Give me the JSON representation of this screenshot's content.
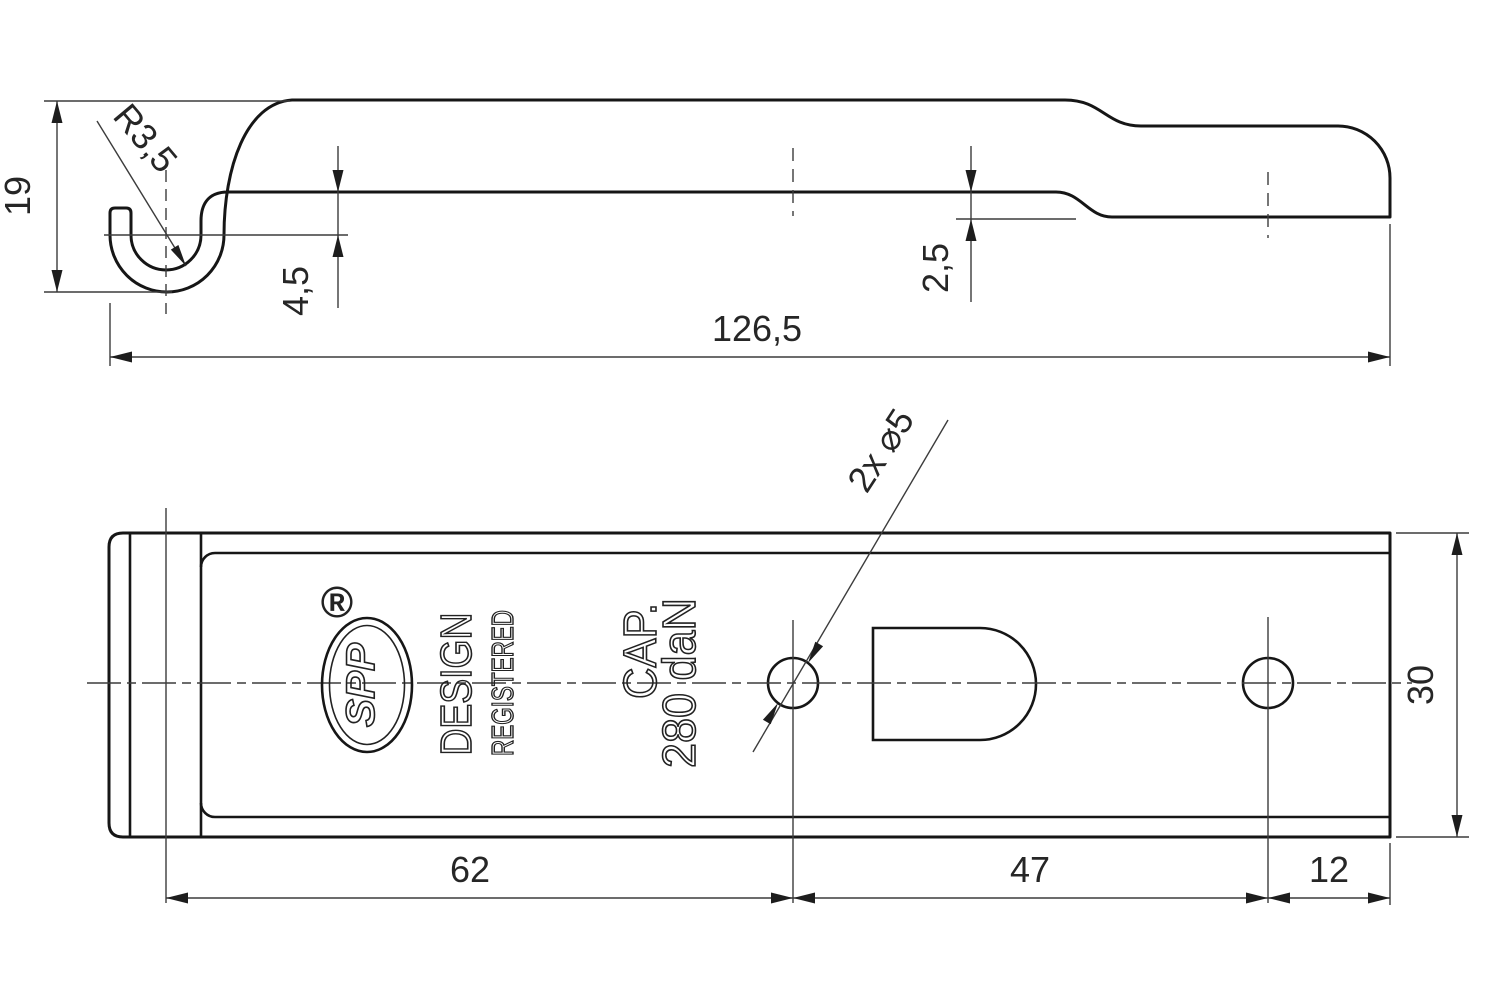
{
  "drawing": {
    "type": "technical-drawing",
    "background": "#ffffff",
    "object_line_color": "#161616",
    "thin_line_color": "#3c3c3c",
    "side_view": {
      "name": "side-profile-view",
      "dims": {
        "height": "19",
        "hook_radius": "R3,5",
        "hook_offset": "4,5",
        "step": "2,5",
        "length": "126,5"
      }
    },
    "plan_view": {
      "name": "top-plan-view",
      "dims": {
        "holes": "2x ⌀5",
        "width": "30",
        "hook_to_hole1": "62",
        "hole1_to_hole2": "47",
        "hole2_to_end": "12"
      },
      "marks": {
        "reg": "®",
        "logo": "SPP",
        "design_line1": "DESIGN",
        "design_line2": "REGISTERED",
        "cap_line1": "CAP.",
        "cap_line2": "280 daN"
      }
    }
  }
}
